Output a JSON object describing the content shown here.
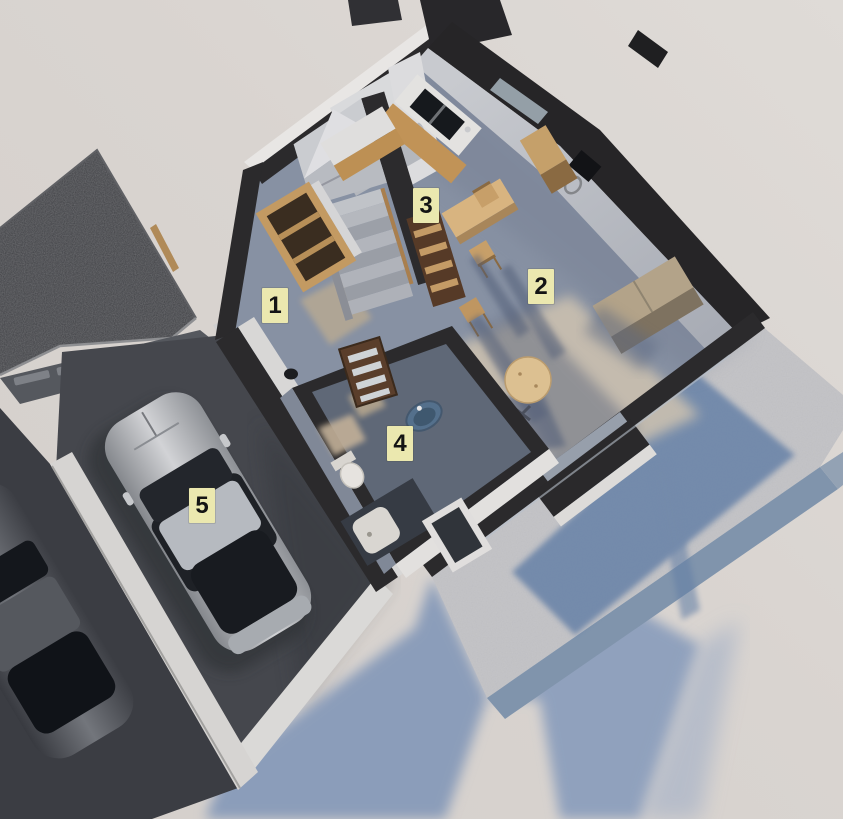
{
  "markers": [
    {
      "label": "1"
    },
    {
      "label": "2"
    },
    {
      "label": "3"
    },
    {
      "label": "4"
    },
    {
      "label": "5"
    }
  ],
  "palette": {
    "marker_bg": "#ebe8af",
    "marker_text": "#141414",
    "ground": "#d9d4d0",
    "ground_light": "#ded9d5",
    "shadow_blue": "#8b9dba",
    "wall_top_dark": "#2b2a2c",
    "wall_face_white": "#e6e4e2",
    "interior_floor": "#8791a3",
    "bathroom_floor": "#5f6877",
    "garage_floor": "#45474d",
    "roof_dark": "#3e3f43",
    "terrace_concrete": "#c5c5c8",
    "terrace_shadow": "#647fa6",
    "wood_light": "#c39a62",
    "wood_dark": "#5a3e2b",
    "car_silver": "#b9bbc0",
    "glass_dark": "#1e2126"
  }
}
